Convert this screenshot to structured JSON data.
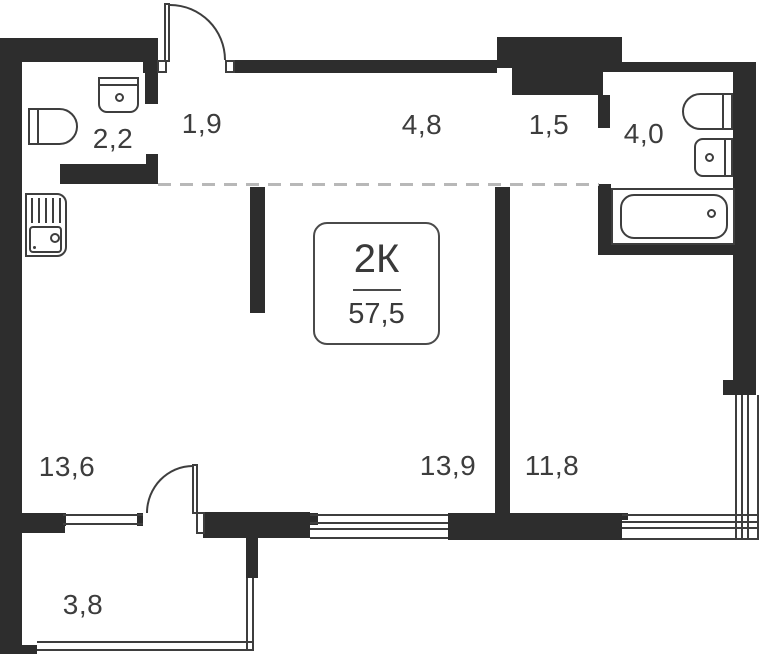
{
  "plan": {
    "title": "apartment-floor-plan",
    "unit_card": {
      "type": "2К",
      "area": "57,5"
    },
    "rooms": [
      {
        "name": "entry-hall",
        "area": "1,9"
      },
      {
        "name": "wc",
        "area": "2,2"
      },
      {
        "name": "corridor",
        "area": "4,8"
      },
      {
        "name": "niche",
        "area": "1,5"
      },
      {
        "name": "bathroom",
        "area": "4,0"
      },
      {
        "name": "kitchen-living",
        "area": "13,6"
      },
      {
        "name": "living-room",
        "area": "13,9"
      },
      {
        "name": "bedroom",
        "area": "11,8"
      },
      {
        "name": "balcony",
        "area": "3,8"
      }
    ],
    "fixtures": [
      "toilet-wc",
      "sink-wc",
      "kitchen-sink",
      "toilet-bathroom",
      "sink-bathroom",
      "bathtub"
    ],
    "doors": [
      "entry-door",
      "balcony-door"
    ],
    "colors": {
      "wall": "#2d2d2d",
      "line": "#3e3e3e",
      "label": "#3d3d3d",
      "dash": "#b8b8b8"
    }
  }
}
